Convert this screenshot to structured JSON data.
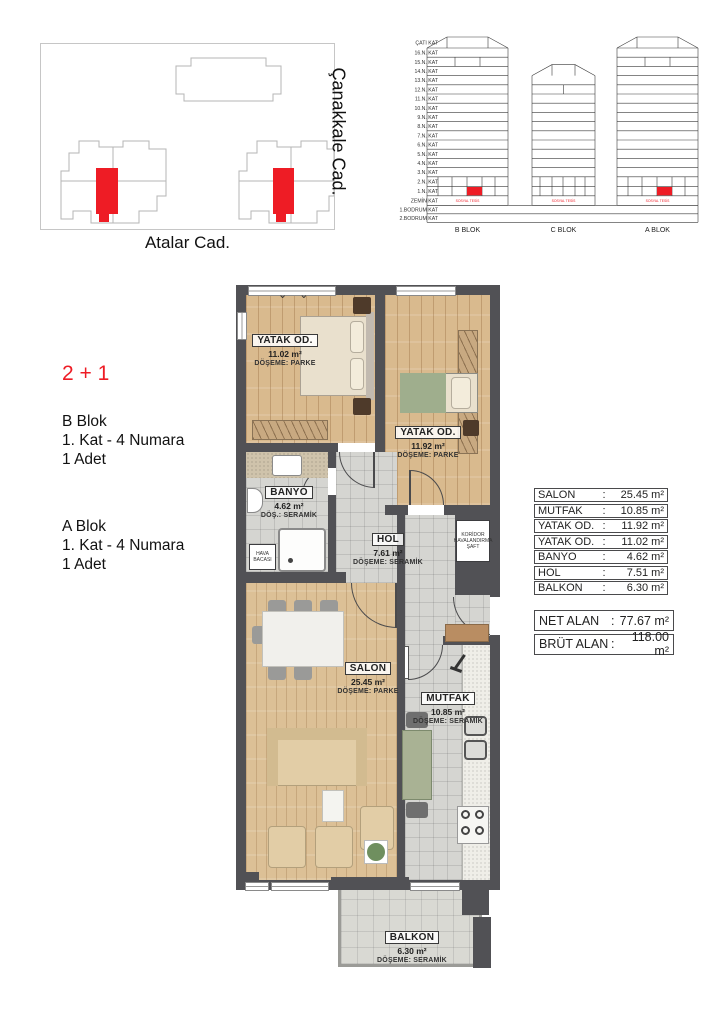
{
  "site_plan": {
    "street_bottom": "Atalar Cad.",
    "street_right": "Çanakkale Cad.",
    "highlight_color": "#ee1c25"
  },
  "elevation": {
    "floors": [
      "ÇATI KAT",
      "16.N. KAT",
      "15.N. KAT",
      "14.N. KAT",
      "13.N. KAT",
      "12.N. KAT",
      "11.N. KAT",
      "10.N. KAT",
      "9.N. KAT",
      "8.N. KAT",
      "7.N. KAT",
      "6.N. KAT",
      "5.N. KAT",
      "4.N. KAT",
      "3.N. KAT",
      "2.N. KAT",
      "1.N. KAT",
      "ZEMİN KAT",
      "1.BODRUM KAT",
      "2.BODRUM KAT"
    ],
    "blocks": [
      "B BLOK",
      "C BLOK",
      "A BLOK"
    ],
    "ground_note": "SOSYAL TESİS",
    "highlight_floor": "1.N. KAT",
    "highlight_color": "#ee1c25"
  },
  "unit_info": {
    "type_label": "2 + 1",
    "type_color": "#ee1c25",
    "entries": [
      {
        "block": "B Blok",
        "floor": "1. Kat - 4 Numara",
        "count": "1 Adet"
      },
      {
        "block": "A Blok",
        "floor": "1. Kat - 4 Numara",
        "count": "1 Adet"
      }
    ]
  },
  "plan": {
    "rooms": {
      "yatak1": {
        "name": "YATAK OD.",
        "area": "11.02 m²",
        "floor": "DÖŞEME: PARKE"
      },
      "yatak2": {
        "name": "YATAK OD.",
        "area": "11.92 m²",
        "floor": "DÖŞEME: PARKE"
      },
      "banyo": {
        "name": "BANYO",
        "area": "4.62 m²",
        "floor": "DÖŞ.: SERAMİK"
      },
      "hol": {
        "name": "HOL",
        "area": "7.61 m²",
        "floor": "DÖŞEME: SERAMİK"
      },
      "salon": {
        "name": "SALON",
        "area": "25.45 m²",
        "floor": "DÖŞEME: PARKE"
      },
      "mutfak": {
        "name": "MUTFAK",
        "area": "10.85 m²",
        "floor": "DÖŞEME: SERAMİK"
      },
      "balkon": {
        "name": "BALKON",
        "area": "6.30 m²",
        "floor": "DÖŞEME: SERAMİK"
      }
    },
    "shaft_label": "KORİDOR HAVALANDIRMA ŞAFT",
    "air_shaft_label": "HAVA BACASI"
  },
  "area_table": {
    "rows": [
      {
        "label": "SALON",
        "value": "25.45 m²"
      },
      {
        "label": "MUTFAK",
        "value": "10.85 m²"
      },
      {
        "label": "YATAK OD.",
        "value": "11.92 m²"
      },
      {
        "label": "YATAK OD.",
        "value": "11.02 m²"
      },
      {
        "label": "BANYO",
        "value": "4.62 m²"
      },
      {
        "label": "HOL",
        "value": "7.51 m²"
      },
      {
        "label": "BALKON",
        "value": "6.30 m²"
      }
    ],
    "totals": [
      {
        "label": "NET ALAN",
        "value": "77.67 m²"
      },
      {
        "label": "BRÜT ALAN",
        "value": "118.00 m²"
      }
    ]
  }
}
